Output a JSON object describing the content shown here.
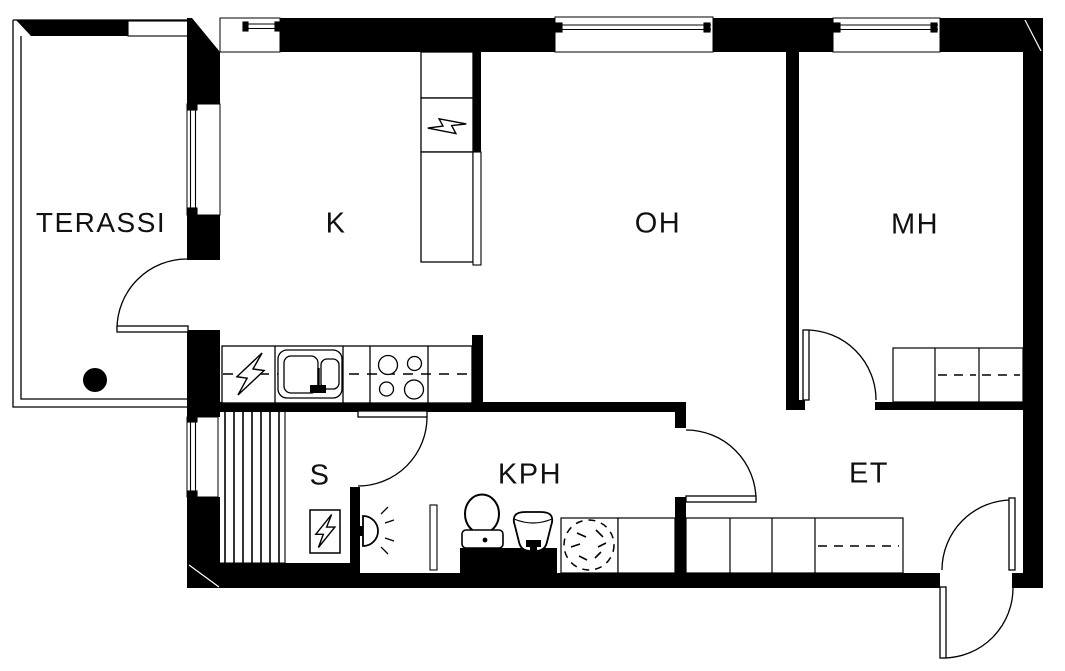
{
  "title": "Apartment floor plan",
  "colors": {
    "background": "#ffffff",
    "line": "#000000",
    "wall": "#000000"
  },
  "rooms": [
    {
      "id": "terassi",
      "label": "TERASSI"
    },
    {
      "id": "k",
      "label": "K"
    },
    {
      "id": "oh",
      "label": "OH"
    },
    {
      "id": "mh",
      "label": "MH"
    },
    {
      "id": "s",
      "label": "S"
    },
    {
      "id": "kph",
      "label": "KPH"
    },
    {
      "id": "et",
      "label": "ET"
    }
  ],
  "fixtures": [
    "terrace-railing",
    "terrace-floor-drain",
    "terrace-door",
    "tall-cabinets",
    "electric-appliance-bolt-icon",
    "kitchen-counter",
    "kitchen-sink",
    "stove-4-burners",
    "sauna-benches",
    "sauna-heater",
    "sauna-door",
    "shower-icon",
    "shower-partition",
    "toilet",
    "washbasin",
    "washing-machine",
    "bathroom-door",
    "bedroom-door",
    "bedroom-bed",
    "hall-wardrobes",
    "entrance-double-swing-door",
    "window-kitchen",
    "window-living-room",
    "window-bedroom",
    "window-kitchen-left",
    "window-sauna"
  ]
}
